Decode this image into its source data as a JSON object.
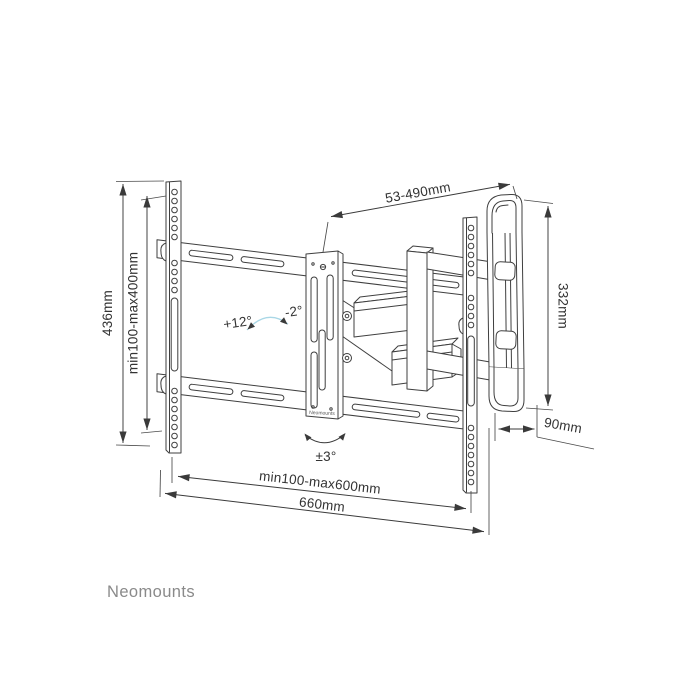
{
  "page": {
    "background": "#ffffff"
  },
  "brand": {
    "name": "Neomounts",
    "color": "#8a8a8a"
  },
  "diagram": {
    "type": "tv-wall-mount-technical-drawing",
    "line_color": "#3f3f3f",
    "accent_color": "#a9d7e6",
    "plate_label": "Neomounts",
    "dimensions": {
      "height_total": "436mm",
      "vesa_height": "min100-max400mm",
      "extension_range": "53-490mm",
      "wall_plate_height": "332mm",
      "depth": "90mm",
      "vesa_width": "min100-max600mm",
      "width_total": "660mm"
    },
    "angles": {
      "tilt_up": "+12°",
      "tilt_down": "-2°",
      "level": "±3°"
    }
  }
}
